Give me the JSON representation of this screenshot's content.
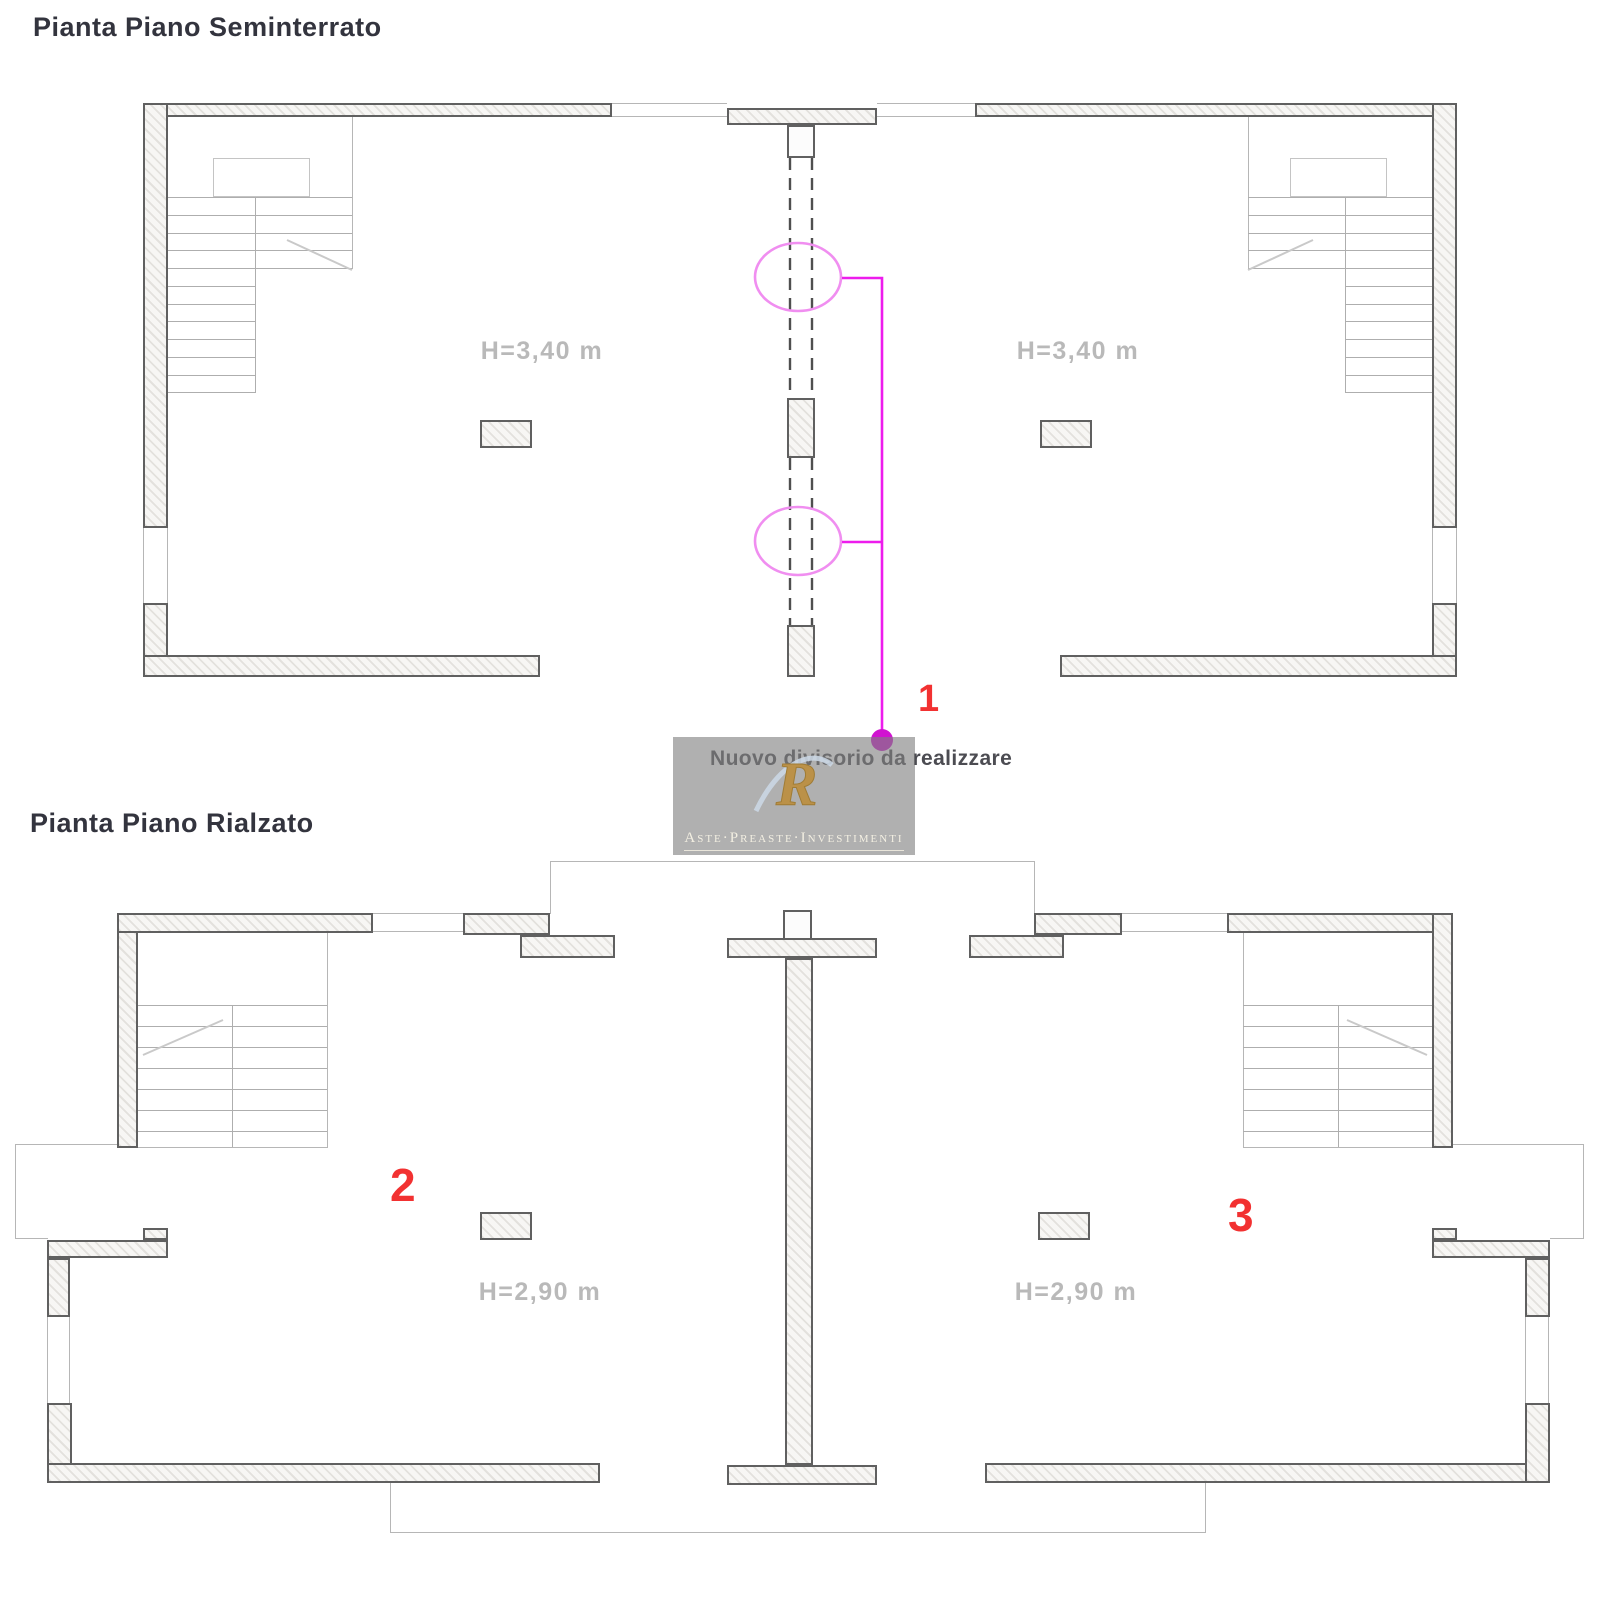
{
  "page": {
    "background": "#ffffff",
    "width": 1600,
    "height": 1600
  },
  "titles": {
    "upper_plan": "Pianta Piano Seminterrato",
    "lower_plan": "Pianta Piano Rialzato"
  },
  "room_labels": {
    "upper_left_height": "H=3,40 m",
    "upper_right_height": "H=3,40 m",
    "lower_left_height": "H=2,90 m",
    "lower_right_height": "H=2,90 m"
  },
  "annotations": {
    "note": "Nuovo divisorio da realizzare",
    "marker_1": "1",
    "marker_2": "2",
    "marker_3": "3"
  },
  "watermark": {
    "caption": "Aste·Preaste·Investimenti",
    "logo_letter": "R"
  },
  "colors": {
    "wall_border": "#606060",
    "thin_line": "#b6b6b6",
    "tread_line": "#aeaeae",
    "height_label_gray": "#b9b9b9",
    "marker_red": "#f23131",
    "annotation_magenta": "#ed1ced",
    "ellipse_pink": "#f08ef0",
    "dot_magenta": "#d013d0",
    "title_text": "#33343e",
    "watermark_gold": "#bb9148",
    "watermark_gray": "#808080"
  },
  "geometry": {
    "walls": [
      [
        143,
        103,
        469,
        14
      ],
      [
        727,
        108,
        150,
        17
      ],
      [
        975,
        103,
        482,
        14
      ],
      [
        143,
        103,
        25,
        425
      ],
      [
        143,
        603,
        25,
        74
      ],
      [
        143,
        655,
        397,
        22
      ],
      [
        1432,
        103,
        25,
        425
      ],
      [
        1432,
        603,
        25,
        74
      ],
      [
        1060,
        655,
        397,
        22
      ],
      [
        787,
        398,
        28,
        60
      ],
      [
        787,
        625,
        28,
        52
      ],
      [
        480,
        420,
        52,
        28
      ],
      [
        1040,
        420,
        52,
        28
      ],
      [
        117,
        913,
        21,
        235
      ],
      [
        117,
        913,
        256,
        20
      ],
      [
        463,
        913,
        87,
        22
      ],
      [
        520,
        935,
        95,
        23
      ],
      [
        969,
        935,
        95,
        23
      ],
      [
        1034,
        913,
        88,
        22
      ],
      [
        1227,
        913,
        226,
        20
      ],
      [
        1432,
        913,
        21,
        235
      ],
      [
        727,
        938,
        150,
        20
      ],
      [
        785,
        958,
        28,
        507
      ],
      [
        727,
        1465,
        150,
        20
      ],
      [
        143,
        1228,
        25,
        12
      ],
      [
        47,
        1240,
        121,
        18
      ],
      [
        47,
        1258,
        23,
        59
      ],
      [
        47,
        1403,
        25,
        80
      ],
      [
        47,
        1463,
        553,
        20
      ],
      [
        985,
        1463,
        565,
        20
      ],
      [
        1525,
        1403,
        25,
        80
      ],
      [
        1525,
        1258,
        25,
        59
      ],
      [
        1432,
        1240,
        118,
        18
      ],
      [
        1432,
        1228,
        25,
        12
      ],
      [
        480,
        1212,
        52,
        28
      ],
      [
        1038,
        1212,
        52,
        28
      ]
    ],
    "open_walls": [
      [
        787,
        125,
        28,
        33
      ],
      [
        783,
        910,
        29,
        30
      ]
    ],
    "thin_rects": [
      [
        612,
        103,
        115,
        1
      ],
      [
        612,
        116,
        115,
        1
      ],
      [
        877,
        103,
        98,
        1
      ],
      [
        877,
        116,
        98,
        1
      ],
      [
        143,
        528,
        1,
        76
      ],
      [
        167,
        528,
        1,
        76
      ],
      [
        1432,
        528,
        1,
        76
      ],
      [
        1456,
        528,
        1,
        76
      ],
      [
        290,
        104,
        1,
        12
      ],
      [
        471,
        104,
        1,
        12
      ],
      [
        1129,
        104,
        1,
        12
      ],
      [
        1310,
        104,
        1,
        12
      ],
      [
        352,
        117,
        1,
        152
      ],
      [
        1248,
        117,
        1,
        152
      ],
      [
        327,
        933,
        1,
        215
      ],
      [
        1243,
        933,
        1,
        215
      ],
      [
        138,
        1147,
        190,
        1
      ],
      [
        1243,
        1147,
        210,
        1
      ],
      [
        373,
        913,
        90,
        1
      ],
      [
        373,
        931,
        90,
        1
      ],
      [
        1107,
        913,
        120,
        1
      ],
      [
        1107,
        931,
        120,
        1
      ],
      [
        47,
        1317,
        1,
        86
      ],
      [
        69,
        1317,
        1,
        86
      ],
      [
        1525,
        1317,
        1,
        86
      ],
      [
        1548,
        1317,
        1,
        86
      ],
      [
        550,
        861,
        485,
        1
      ],
      [
        550,
        861,
        1,
        53
      ],
      [
        1034,
        861,
        1,
        53
      ],
      [
        15,
        1144,
        103,
        1
      ],
      [
        15,
        1144,
        1,
        95
      ],
      [
        15,
        1238,
        33,
        1
      ],
      [
        1453,
        1144,
        131,
        1
      ],
      [
        1583,
        1144,
        1,
        95
      ],
      [
        1550,
        1238,
        34,
        1
      ],
      [
        390,
        1483,
        1,
        50
      ],
      [
        390,
        1532,
        816,
        1
      ],
      [
        1205,
        1483,
        1,
        50
      ],
      [
        788,
        140,
        26,
        1
      ]
    ],
    "outline_rects": [
      [
        213,
        158,
        97,
        39
      ],
      [
        1290,
        158,
        97,
        39
      ]
    ],
    "tread_lines": [
      [
        168,
        197,
        184,
        1
      ],
      [
        168,
        215,
        184,
        1
      ],
      [
        168,
        233,
        184,
        1
      ],
      [
        168,
        250,
        184,
        1
      ],
      [
        168,
        268,
        184,
        1
      ],
      [
        168,
        286,
        87,
        1
      ],
      [
        168,
        304,
        87,
        1
      ],
      [
        168,
        321,
        87,
        1
      ],
      [
        168,
        339,
        87,
        1
      ],
      [
        168,
        357,
        87,
        1
      ],
      [
        168,
        375,
        87,
        1
      ],
      [
        168,
        392,
        87,
        1
      ],
      [
        1248,
        197,
        184,
        1
      ],
      [
        1248,
        215,
        184,
        1
      ],
      [
        1248,
        233,
        184,
        1
      ],
      [
        1248,
        250,
        184,
        1
      ],
      [
        1248,
        268,
        184,
        1
      ],
      [
        1345,
        286,
        87,
        1
      ],
      [
        1345,
        304,
        87,
        1
      ],
      [
        1345,
        321,
        87,
        1
      ],
      [
        1345,
        339,
        87,
        1
      ],
      [
        1345,
        357,
        87,
        1
      ],
      [
        1345,
        375,
        87,
        1
      ],
      [
        1345,
        392,
        87,
        1
      ],
      [
        255,
        197,
        1,
        196
      ],
      [
        1345,
        197,
        1,
        196
      ],
      [
        138,
        1005,
        189,
        1
      ],
      [
        138,
        1026,
        189,
        1
      ],
      [
        138,
        1047,
        189,
        1
      ],
      [
        138,
        1068,
        189,
        1
      ],
      [
        138,
        1089,
        189,
        1
      ],
      [
        138,
        1110,
        189,
        1
      ],
      [
        138,
        1131,
        189,
        1
      ],
      [
        1243,
        1005,
        189,
        1
      ],
      [
        1243,
        1026,
        189,
        1
      ],
      [
        1243,
        1047,
        189,
        1
      ],
      [
        1243,
        1068,
        189,
        1
      ],
      [
        1243,
        1089,
        189,
        1
      ],
      [
        1243,
        1110,
        189,
        1
      ],
      [
        1243,
        1131,
        189,
        1
      ],
      [
        232,
        1005,
        1,
        142
      ],
      [
        1338,
        1005,
        1,
        142
      ]
    ]
  }
}
